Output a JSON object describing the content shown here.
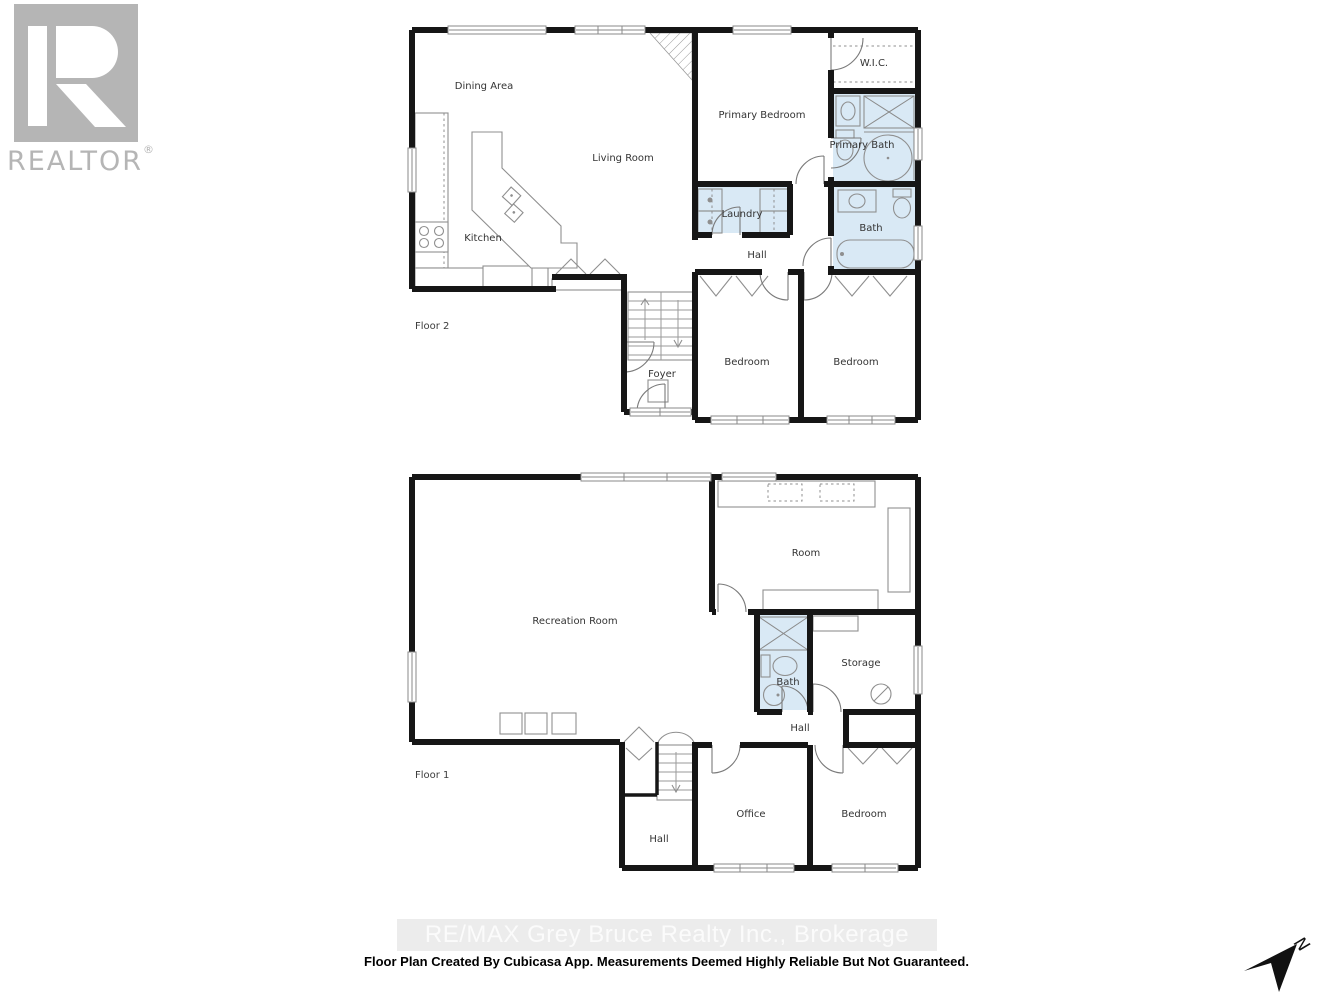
{
  "branding": {
    "logo_text": "REALTOR",
    "registered": "®"
  },
  "watermark": "RE/MAX Grey Bruce Realty Inc., Brokerage",
  "footer": "Floor Plan Created By Cubicasa App. Measurements Deemed Highly Reliable But Not Guaranteed.",
  "compass": {
    "north_label": "N"
  },
  "floor2": {
    "label": "Floor 2",
    "rooms": {
      "dining": "Dining Area",
      "living": "Living Room",
      "kitchen": "Kitchen",
      "primary_bedroom": "Primary Bedroom",
      "wic": "W.I.C.",
      "primary_bath": "Primary Bath",
      "laundry": "Laundry",
      "bath": "Bath",
      "hall": "Hall",
      "foyer": "Foyer",
      "bedroom_left": "Bedroom",
      "bedroom_right": "Bedroom"
    }
  },
  "floor1": {
    "label": "Floor 1",
    "rooms": {
      "recreation": "Recreation Room",
      "room": "Room",
      "bath": "Bath",
      "storage": "Storage",
      "hall_upper": "Hall",
      "hall_lower": "Hall",
      "office": "Office",
      "bedroom": "Bedroom"
    }
  },
  "colors": {
    "wet_area_fill": "#d9e9f5",
    "wall": "#161616",
    "fixture_line": "#8f8f8f",
    "logo_gray": "#b5b5b5",
    "watermark_bg": "#ececec",
    "watermark_text": "#fbfbfb",
    "footer_text": "#000000"
  }
}
